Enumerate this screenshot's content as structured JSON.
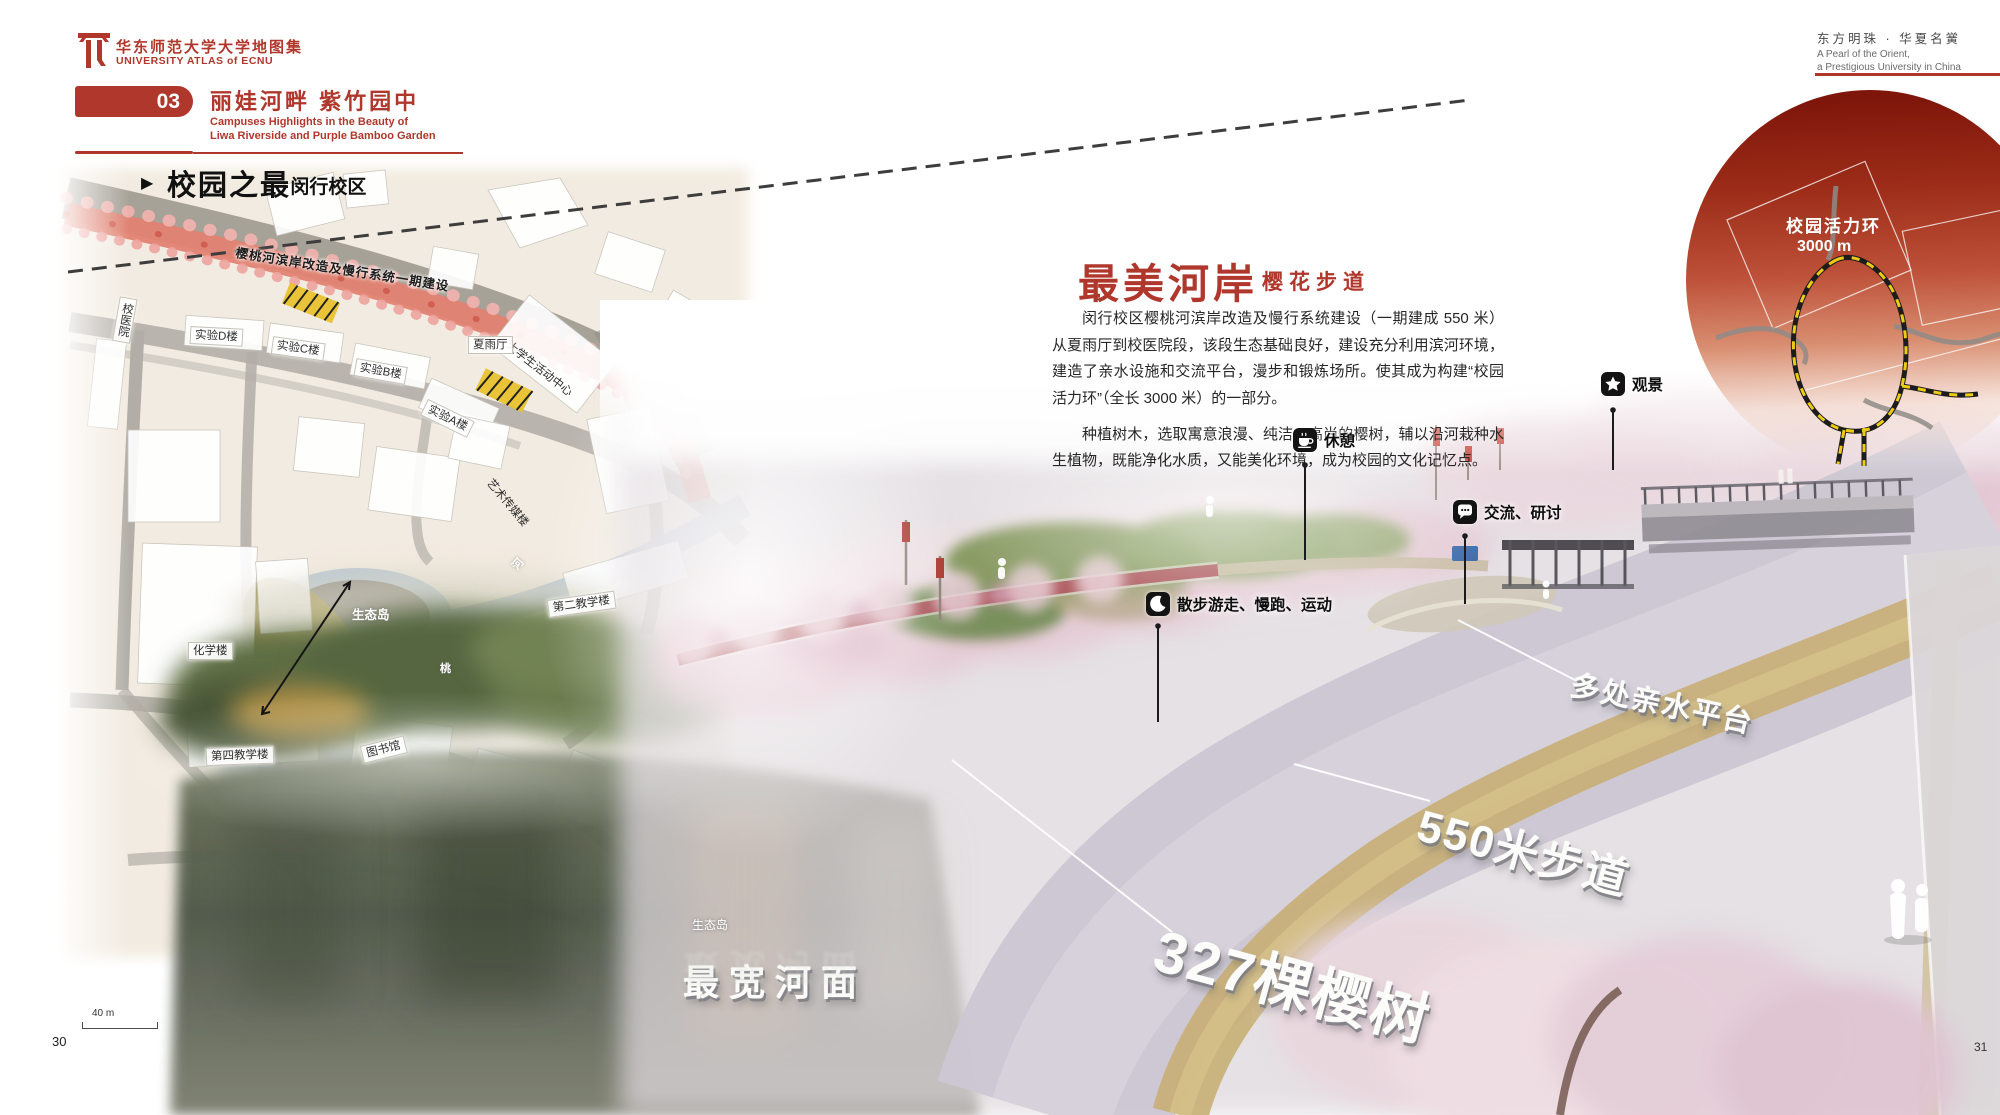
{
  "header": {
    "atlas_title_zh": "华东师范大学大学地图集",
    "atlas_title_en": "UNIVERSITY ATLAS of ECNU",
    "chapter_number": "03",
    "chapter_title_zh": "丽娃河畔 紫竹园中",
    "chapter_en_line1": "Campuses Highlights in the Beauty of",
    "chapter_en_line2": "Liwa Riverside and Purple Bamboo Garden",
    "motto_zh": "东方明珠 · 华夏名黉",
    "motto_en_line1": "A Pearl of the Orient,",
    "motto_en_line2": "a Prestigious University in China"
  },
  "section": {
    "marker": "▶",
    "title_zh": "校园之最",
    "subtitle_zh": "·闵行校区"
  },
  "map": {
    "project_label": "樱桃河滨岸改造及慢行系统一期建设",
    "labels": [
      {
        "t": "校医院"
      },
      {
        "t": "实验D楼"
      },
      {
        "t": "实验C楼"
      },
      {
        "t": "实验B楼"
      },
      {
        "t": "实验A楼"
      },
      {
        "t": "大学生活动中心"
      },
      {
        "t": "夏雨厅"
      },
      {
        "t": "艺术传媒楼"
      },
      {
        "t": "生态岛"
      },
      {
        "t": "化学楼"
      },
      {
        "t": "第二教学楼"
      },
      {
        "t": "第四教学楼"
      },
      {
        "t": "图书馆"
      },
      {
        "t": "河"
      },
      {
        "t": "桃"
      }
    ],
    "island_photo_label": "生态岛",
    "scale_label": "40 m"
  },
  "article": {
    "title_zh": "最美河岸",
    "dot": "·",
    "subtitle_zh": "樱花步道",
    "para1": "闵行校区樱桃河滨岸改造及慢行系统建设（一期建成 550 米）从夏雨厅到校医院段，该段生态基础良好，建设充分利用滨河环境，建造了亲水设施和交流平台，漫步和锻炼场所。使其成为构建“校园活力环”（全长 3000 米）的一部分。",
    "para2": "种植树木，选取寓意浪漫、纯洁、高尚的樱树，辅以沿河栽种水生植物，既能净化水质，又能美化环境，成为校园的文化记忆点。"
  },
  "callouts": [
    {
      "label": "观景"
    },
    {
      "label": "休憩"
    },
    {
      "label": "交流、研讨"
    },
    {
      "label": "散步游走、慢跑、运动"
    }
  ],
  "annotations": [
    {
      "text": "多处亲水平台"
    },
    {
      "text": "550米步道"
    },
    {
      "text": "327棵樱树"
    },
    {
      "text": "最宽河面"
    }
  ],
  "inset": {
    "title": "校园活力环",
    "length": "3000 m"
  },
  "pages": {
    "left": "30",
    "right": "31"
  }
}
